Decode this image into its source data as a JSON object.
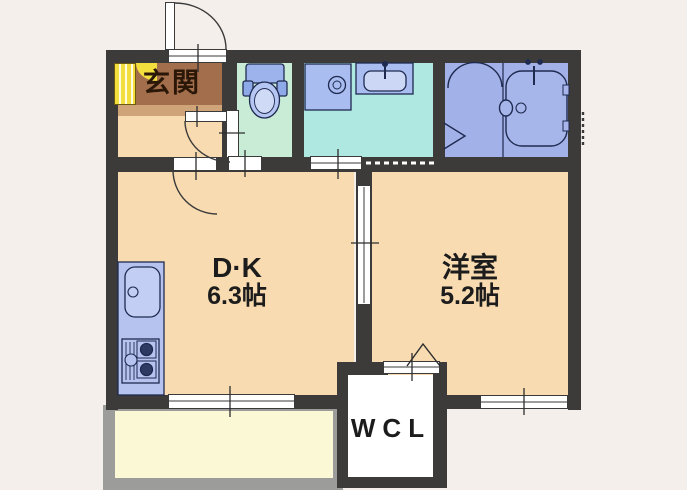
{
  "rooms": {
    "genkan": {
      "label": "玄関"
    },
    "dk": {
      "label": "D·K",
      "size": "6.3帖"
    },
    "western": {
      "label": "洋室",
      "size": "5.2帖"
    },
    "wcl": {
      "label": "WCL"
    }
  },
  "fixtures": [
    "entrance-door",
    "shoe-cabinet",
    "toilet",
    "washing-machine-pan",
    "vanity-sink",
    "bathtub",
    "kitchen-sink",
    "gas-stove",
    "sliding-door",
    "folding-door",
    "balcony",
    "window"
  ],
  "colors": {
    "background": "#f5efec",
    "wall": "#3c3b39",
    "room_cream": "#f8dbb0",
    "genkan_brown": "#a36e4b",
    "genkan_step": "#cfa478",
    "toilet_mint": "#c9ecd7",
    "washroom_teal": "#aee8e0",
    "bath_blue": "#a2b2e8",
    "fixture_blue": "#a9bdf0",
    "fixture_outline": "#1f2a50",
    "kitchen_counter": "#b6c3ee",
    "shoebox_yellow": "#f2df3e",
    "balcony_floor": "#fbf8d6",
    "balcony_frame": "#9c9c9a",
    "wcl_floor": "#ffffff"
  }
}
